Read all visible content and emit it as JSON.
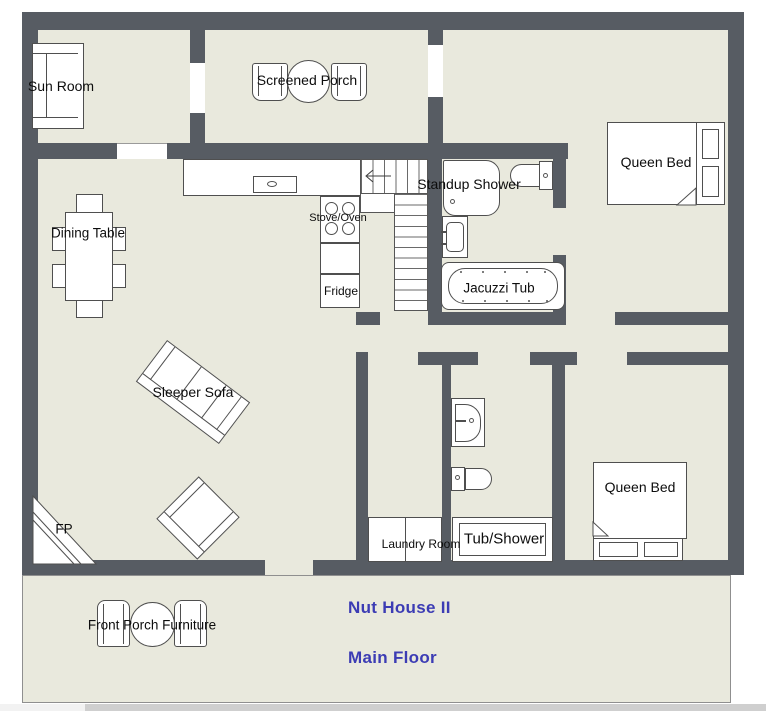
{
  "colors": {
    "wall": "#575c63",
    "floor": "#e9e9dd",
    "outline": "#4f4f4f",
    "title": "#3c3cb4",
    "scrollbar_track": "#cfcfcf",
    "scrollbar_left": "#f2f2f2"
  },
  "labels": {
    "sun_room": "Sun Room",
    "screened_porch": "Screened Porch",
    "queen_bed_top": "Queen Bed",
    "standup_shower": "Standup Shower",
    "stove_oven": "Stove/Oven",
    "fridge": "Fridge",
    "dining_table": "Dining Table",
    "jacuzzi_tub": "Jacuzzi Tub",
    "sleeper_sofa": "Sleeper Sofa",
    "fireplace": "FP",
    "laundry_room": "Laundry Room",
    "tub_shower": "Tub/Shower",
    "queen_bed_bottom": "Queen Bed",
    "front_porch": "Front Porch Furniture"
  },
  "title": {
    "name": "Nut House II",
    "floor": "Main Floor"
  }
}
